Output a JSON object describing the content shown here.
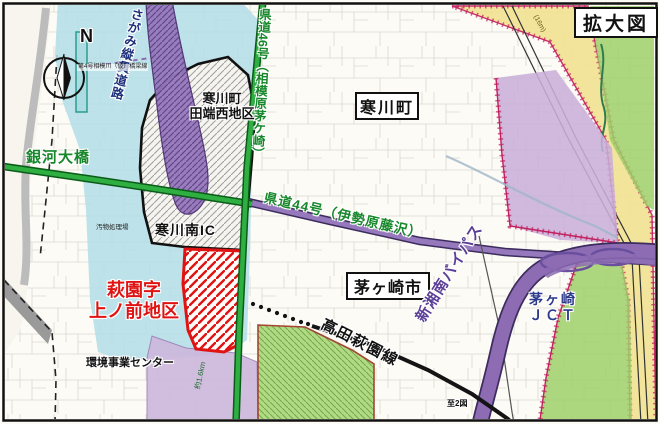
{
  "figure": {
    "title": "拡大図"
  },
  "compass": {
    "n": "N"
  },
  "municipalities": {
    "samukawa": "寒川町",
    "chigasaki": "茅ヶ崎市"
  },
  "districts": {
    "tabata_nishi": {
      "line1": "寒川町",
      "line2": "田端西地区"
    },
    "hagisono": {
      "line1": "萩園字",
      "line2": "上ノ前地区"
    }
  },
  "roads": {
    "sagami_expressway": "さがみ縦貫道路",
    "kendo46": "県道46号（相模原茅ケ崎）",
    "kendo44": "県道44号（伊勢原藤沢）",
    "ginga_bridge": "銀河大橋",
    "takada_hagisono_line": "高田萩園線",
    "shin_shonan_bypass": "新湘南バイパス",
    "bridge_plan": "第4号相模川（仮）橋梁線"
  },
  "facilities": {
    "samukawa_minami_ic": "寒川南IC",
    "chigasaki_jct": {
      "line1": "茅ヶ崎",
      "line2": "ＪＣＴ"
    },
    "kankyo_center": "環境事業センター",
    "obutsu_plant": "汚物処理場"
  },
  "annotations": {
    "to_map2": "至2図",
    "width_note": "(16m)",
    "length_note": "約1.6km"
  },
  "colors": {
    "urban_cyan": "#b5dee8",
    "expressway_purple": "#8d6cb4",
    "pref_road_green": "#2fae42",
    "zone_yellow": "#f2e394",
    "zone_green": "#9fd06a",
    "zone_lavender": "#cdb7dc",
    "district_red": "#e01313",
    "boundary_crimson": "#c22060",
    "road_black": "#141414"
  }
}
